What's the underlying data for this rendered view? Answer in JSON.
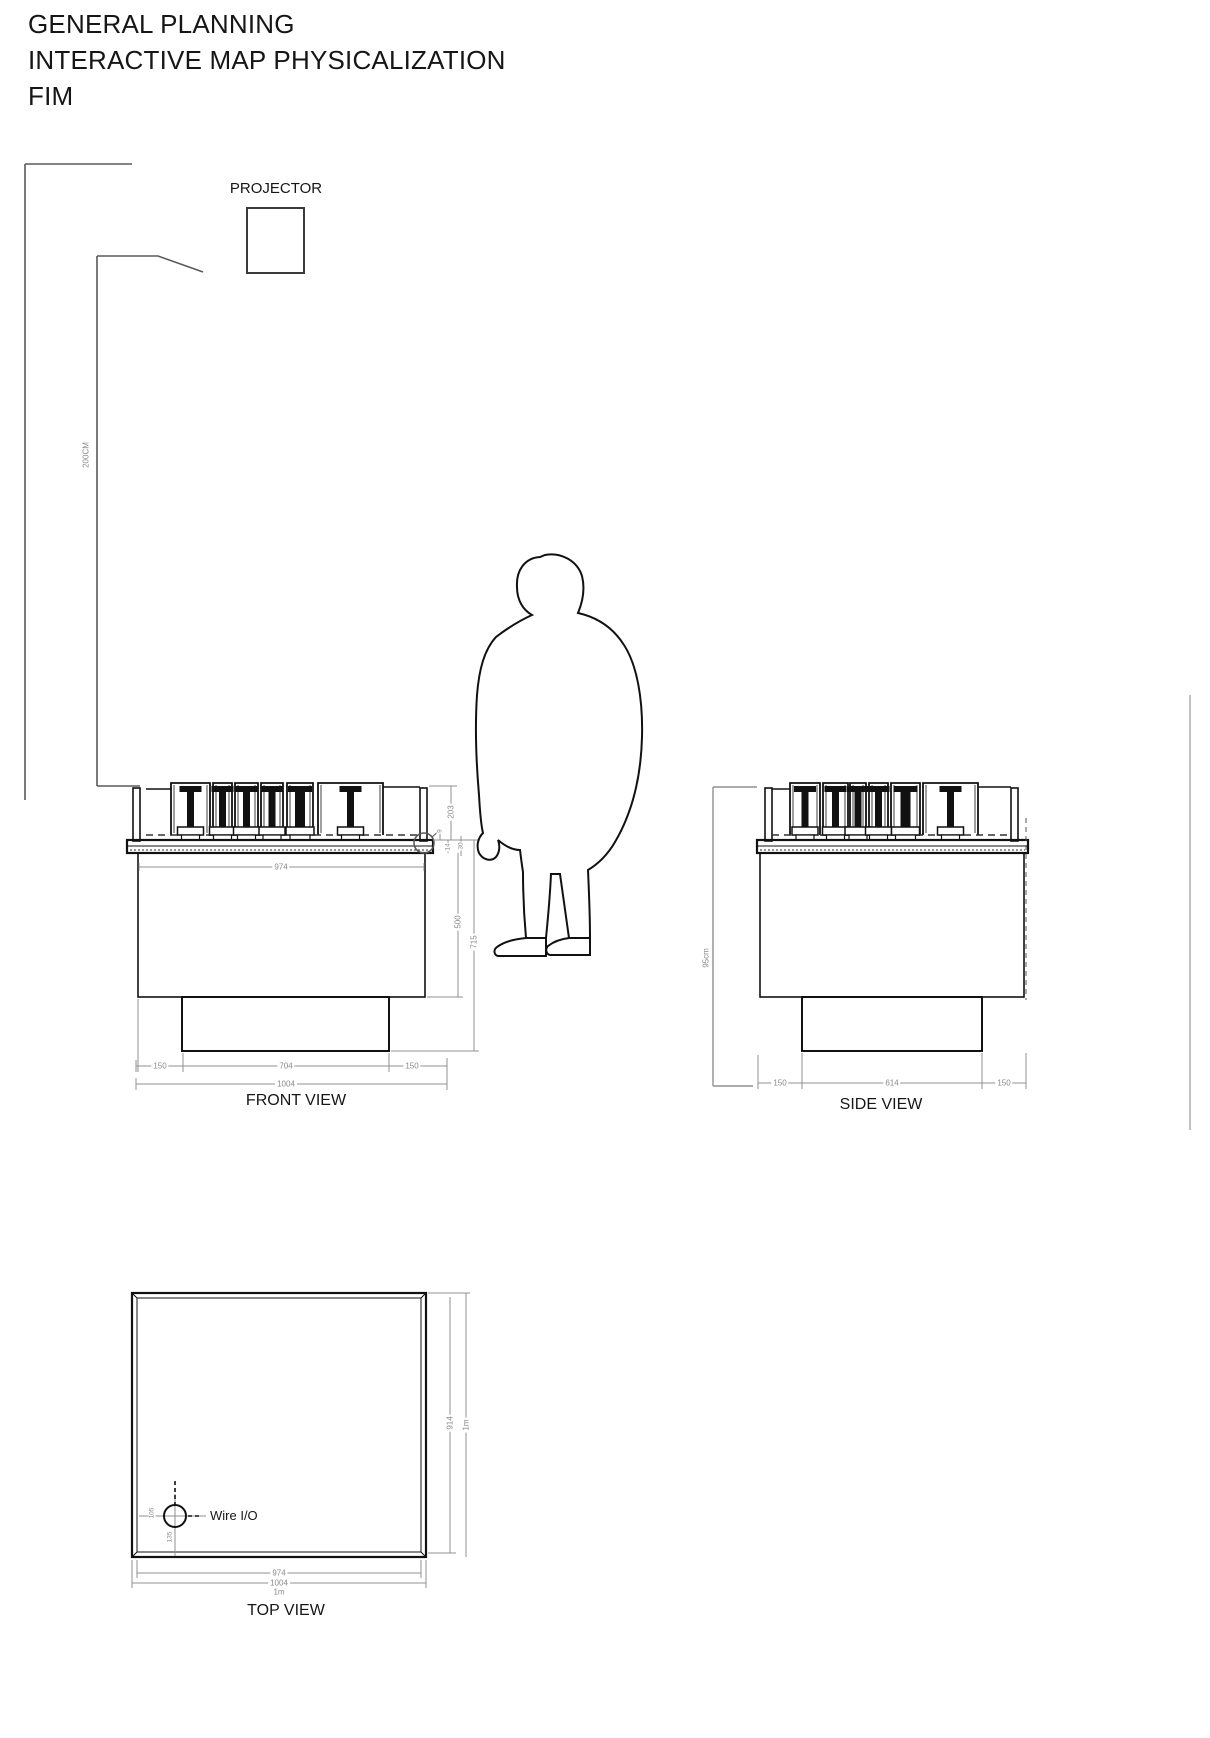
{
  "title": {
    "line1": "GENERAL PLANNING",
    "line2": "INTERACTIVE MAP PHYSICALIZATION",
    "line3": "FIM"
  },
  "projector": {
    "label": "PROJECTOR",
    "throw_height": "200CM"
  },
  "front_view": {
    "label": "FRONT VIEW",
    "dims": {
      "surface_width": "974",
      "mechanism_height": "203",
      "detail_top": "9",
      "detail_mid": "14",
      "detail_low": "30",
      "body_height": "500",
      "total_height": "715",
      "left_margin": "150",
      "base_width": "704",
      "right_margin": "150",
      "total_width": "1004"
    }
  },
  "side_view": {
    "label": "SIDE VIEW",
    "dims": {
      "overall_height": "95cm",
      "left_margin": "150",
      "base_depth": "614",
      "right_margin": "150"
    }
  },
  "top_view": {
    "label": "TOP VIEW",
    "wire_label": "Wire I/O",
    "dims": {
      "wire_offset_x": "105",
      "wire_offset_y": "135",
      "inner_width": "974",
      "outer_width": "1004",
      "width_nominal": "1m",
      "depth": "914",
      "depth_nominal": "1m"
    }
  },
  "colors": {
    "line": "#1c1c1c",
    "dimension": "#909090"
  }
}
